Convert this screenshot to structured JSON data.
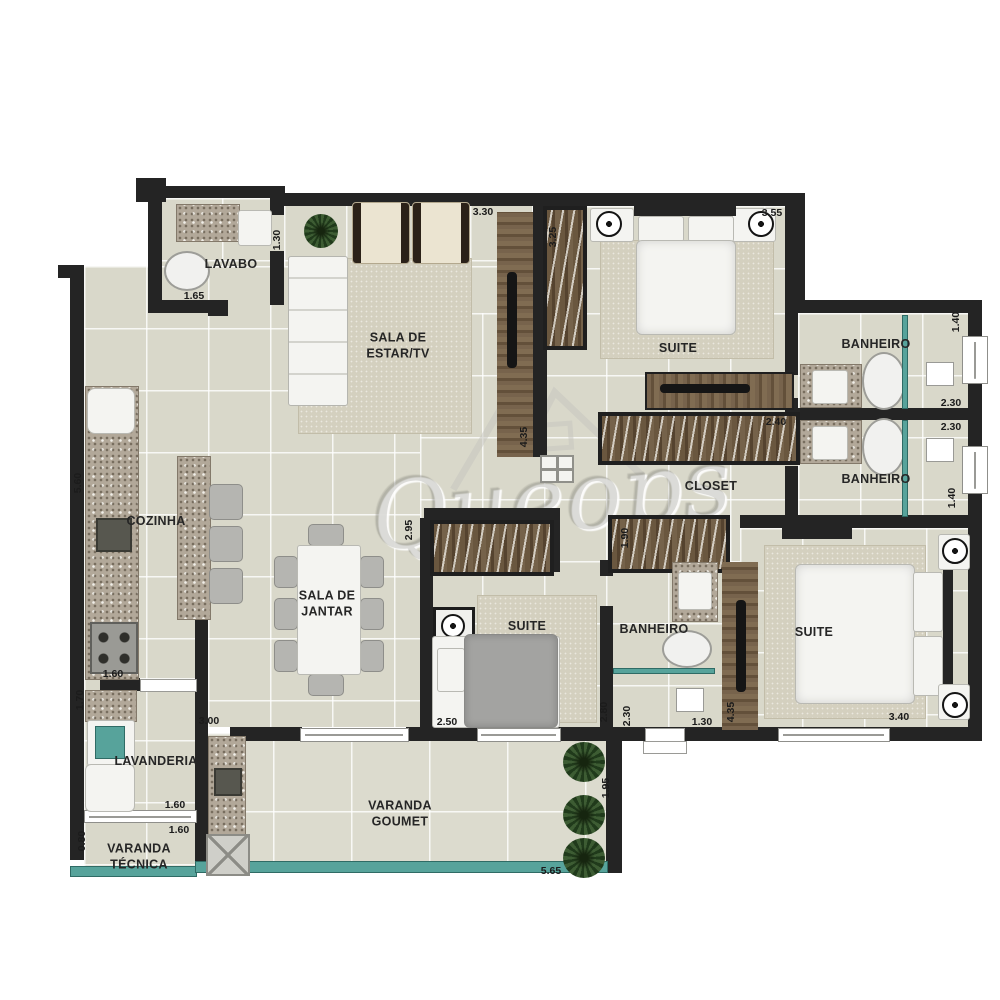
{
  "watermark": {
    "brand": "Queops"
  },
  "rooms": {
    "lavabo": "LAVABO",
    "sala_estar": "SALA DE\nESTAR/TV",
    "suite_top": "SUITE",
    "banheiro_top": "BANHEIRO",
    "banheiro_right": "BANHEIRO",
    "closet": "CLOSET",
    "cozinha": "COZINHA",
    "sala_jantar": "SALA DE\nJANTAR",
    "suite_mid": "SUITE",
    "banheiro_mid": "BANHEIRO",
    "suite_right": "SUITE",
    "lavanderia": "LAVANDERIA",
    "varanda_tecnica": "VARANDA\nTÉCNICA",
    "varanda_goumet": "VARANDA\nGOUMET"
  },
  "dims": {
    "d330": "3.30",
    "d355": "3.55",
    "d130_lavabo": "1.30",
    "d165": "1.65",
    "d325": "3.25",
    "d140_top": "1.40",
    "d230_a": "2.30",
    "d230_b": "2.30",
    "d140_bot": "1.40",
    "d435_living": "4.35",
    "d240": "2.40",
    "d295": "2.95",
    "d190": "1.90",
    "d560": "5.60",
    "d160_kitchen": "1.60",
    "d170": "1.70",
    "d300": "3.00",
    "d250": "2.50",
    "d280": "2.80",
    "d230_ban": "2.30",
    "d130_ban": "1.30",
    "d435_suite": "4.35",
    "d340": "3.40",
    "d195": "1.95",
    "d160_lav": "1.60",
    "d160_var": "1.60",
    "d080": "0.80",
    "d565": "5.65"
  }
}
